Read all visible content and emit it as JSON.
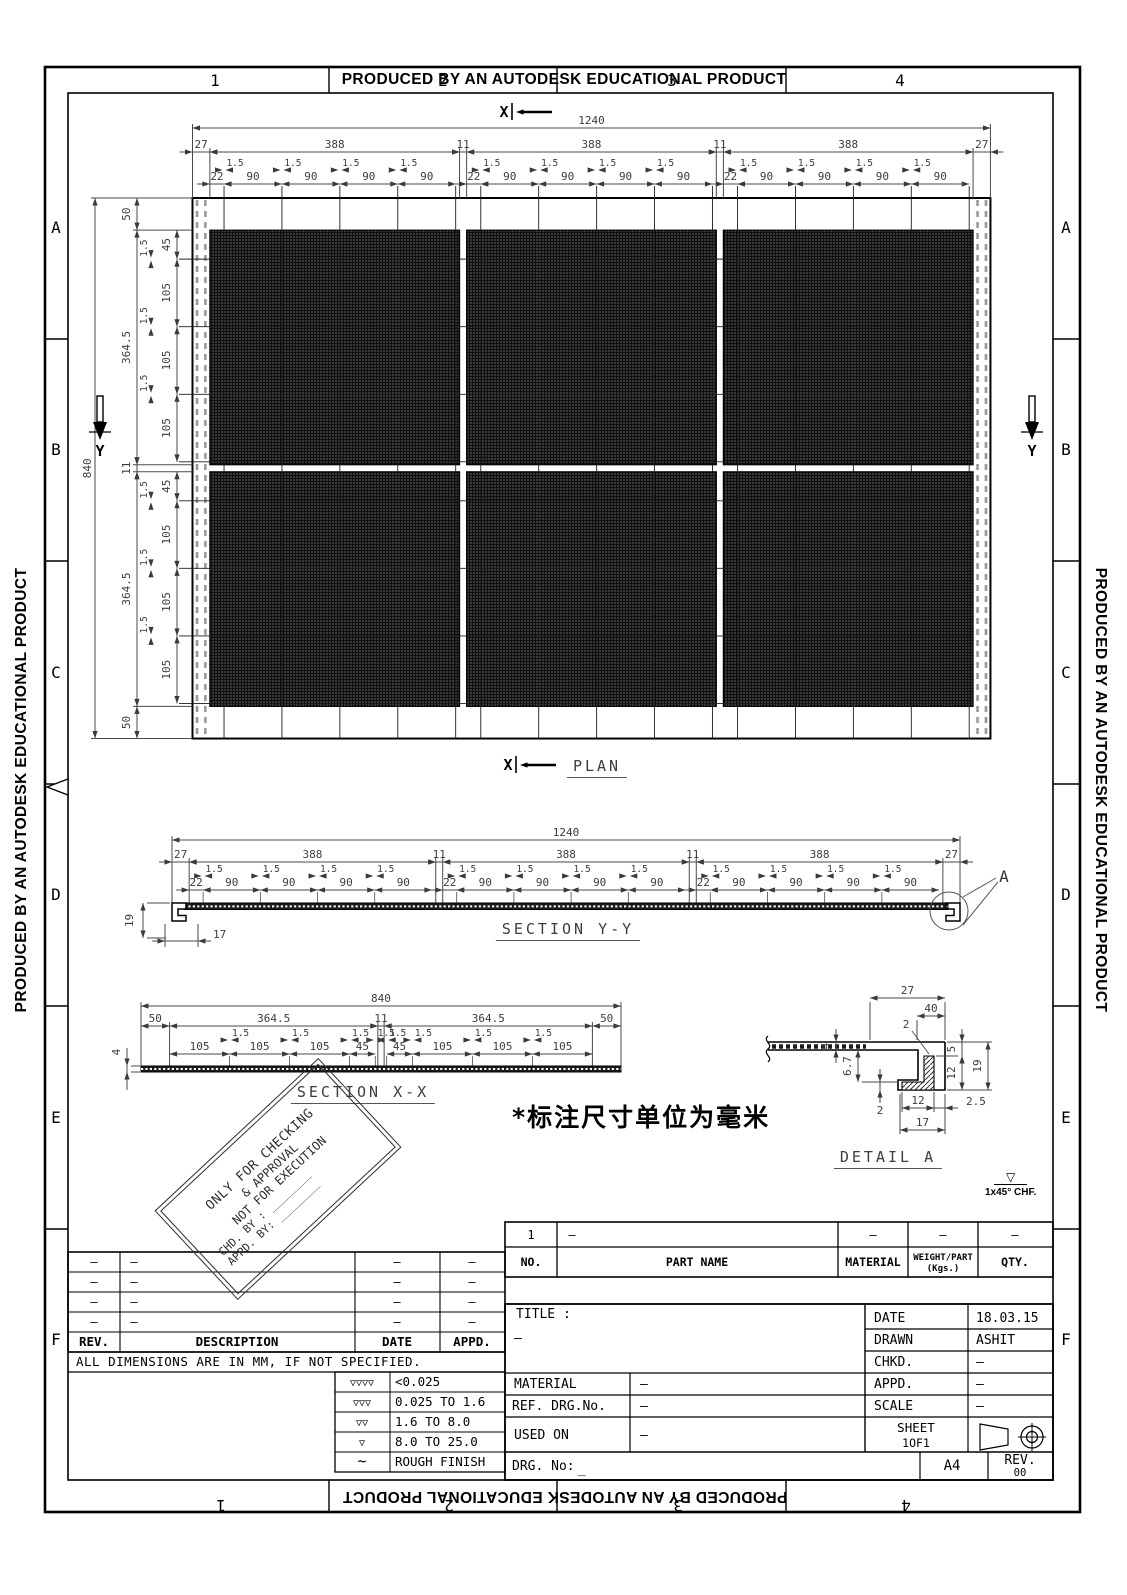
{
  "sheet": {
    "producer_text": "PRODUCED BY AN AUTODESK EDUCATIONAL PRODUCT",
    "zone_columns": [
      "1",
      "2",
      "3",
      "4"
    ],
    "zone_rows": [
      "A",
      "B",
      "C",
      "D",
      "E",
      "F"
    ]
  },
  "plan": {
    "title": "PLAN",
    "overall_width": "1240",
    "overall_height": "840",
    "width_chain": [
      "27",
      "388",
      "11",
      "388",
      "11",
      "388",
      "27"
    ],
    "width_sub_chain": [
      "22",
      "90",
      "90",
      "90",
      "90"
    ],
    "height_chain": [
      "50",
      "364.5",
      "11",
      "364.5",
      "50"
    ],
    "height_sub_chain": [
      "45",
      "105",
      "105",
      "105"
    ],
    "bar_gap": "1.5",
    "section_marker_x": "X",
    "section_marker_y": "Y"
  },
  "section_yy": {
    "title": "SECTION Y-Y",
    "overall": "1240",
    "chain": [
      "27",
      "388",
      "11",
      "388",
      "11",
      "388",
      "27"
    ],
    "sub_chain": [
      "22",
      "90",
      "90",
      "90",
      "90"
    ],
    "bar_gap": "1.5",
    "edge_height": "19",
    "edge_return": "17",
    "detail_label": "A"
  },
  "section_xx": {
    "title": "SECTION X-X",
    "overall": "840",
    "chain": [
      "50",
      "364.5",
      "11",
      "364.5",
      "50"
    ],
    "sub_chain_left": [
      "105",
      "105",
      "105",
      "45"
    ],
    "sub_chain_right": [
      "45",
      "105",
      "105",
      "105"
    ],
    "bar_gap": "1.5",
    "thickness": "4"
  },
  "detail_a": {
    "title": "DETAIL A",
    "top_width": "27",
    "top_inner": "40",
    "wall_thickness": "2",
    "leg_top": "5",
    "leg_inner": "12",
    "leg_height": "19",
    "plate_thickness": "4",
    "ledge_gap": "6.7",
    "foot_thickness": "2",
    "foot_inner": "12",
    "foot_wall": "2.5",
    "foot_width": "17"
  },
  "notes": {
    "units": "*标注尺寸单位为毫米",
    "chamfer": "1x45° CHF."
  },
  "stamp": {
    "lines": [
      "ONLY FOR CHECKING",
      "& APPROVAL",
      "NOT FOR EXECUTION",
      "CHD. BY : ________",
      "APPD. BY: ________"
    ]
  },
  "parts_table": {
    "headers": [
      "NO.",
      "PART NAME",
      "MATERIAL",
      "WEIGHT/PART",
      "QTY."
    ],
    "headers_sub": "(Kgs.)",
    "rows": [
      [
        "1",
        "–",
        "–",
        "–",
        "–"
      ]
    ]
  },
  "title_block": {
    "title_label": "TITLE :",
    "title_value": "–",
    "material_label": "MATERIAL",
    "material_value": "–",
    "ref_label": "REF. DRG.No.",
    "ref_value": "–",
    "used_on_label": "USED ON",
    "used_on_value": "–",
    "drg_label": "DRG. No:",
    "drg_value": "_",
    "date_label": "DATE",
    "date_value": "18.03.15",
    "drawn_label": "DRAWN",
    "drawn_value": "ASHIT",
    "chkd_label": "CHKD.",
    "chkd_value": "–",
    "appd_label": "APPD.",
    "appd_value": "–",
    "scale_label": "SCALE",
    "scale_value": "–",
    "sheet_label": "SHEET",
    "sheet_value": "1OF1",
    "paper_size": "A4",
    "rev_label": "REV.",
    "rev_value": "00"
  },
  "rev_table": {
    "headers": [
      "REV.",
      "DESCRIPTION",
      "DATE",
      "APPD."
    ],
    "rows": [
      [
        "–",
        "–",
        "–",
        "–"
      ],
      [
        "–",
        "–",
        "–",
        "–"
      ],
      [
        "–",
        "–",
        "–",
        "–"
      ],
      [
        "–",
        "–",
        "–",
        "–"
      ]
    ],
    "note": "ALL DIMENSIONS ARE IN MM, IF NOT SPECIFIED."
  },
  "finish_table": {
    "rows": [
      {
        "symbol": "▽▽▽▽",
        "range": "<0.025"
      },
      {
        "symbol": "▽▽▽",
        "range": "0.025 TO 1.6"
      },
      {
        "symbol": "▽▽",
        "range": "1.6 TO 8.0"
      },
      {
        "symbol": "▽",
        "range": "8.0 TO 25.0"
      },
      {
        "symbol": "~",
        "range": "ROUGH FINISH"
      }
    ]
  }
}
